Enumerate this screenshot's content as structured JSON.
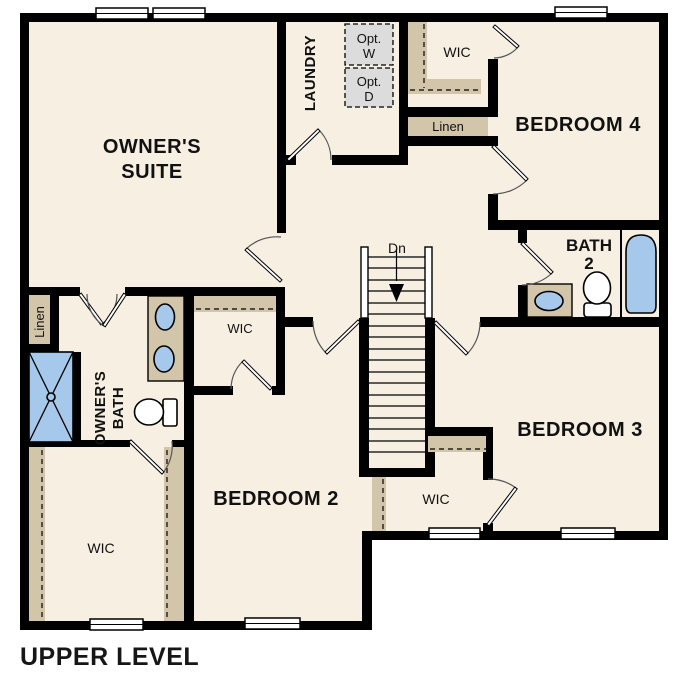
{
  "floor_plan": {
    "caption": "UPPER LEVEL",
    "rooms": {
      "owners_suite": {
        "line1": "OWNER'S",
        "line2": "SUITE"
      },
      "laundry": "LAUNDRY",
      "bedroom4": "BEDROOM 4",
      "bedroom3": "BEDROOM 3",
      "bedroom2": "BEDROOM 2",
      "bath2": {
        "line1": "BATH",
        "line2": "2"
      },
      "owners_bath": {
        "line1": "OWNER'S",
        "line2": "BATH"
      }
    },
    "closets": {
      "wic_top": "WIC",
      "wic_left": "WIC",
      "wic_bottom_left": "WIC",
      "wic_middle": "WIC",
      "linen_top": "Linen",
      "linen_left": "Linen"
    },
    "appliances": {
      "opt_washer": {
        "line1": "Opt.",
        "line2": "W"
      },
      "opt_dryer": {
        "line1": "Opt.",
        "line2": "D"
      }
    },
    "stairs": {
      "down_label": "Dn"
    },
    "colors": {
      "floor": "#f6efe2",
      "wall": "#000000",
      "shelf_tan": "#d3c5a9",
      "fixture_blue": "#a6c8ea",
      "appliance_gray": "#dcdcdc"
    }
  }
}
